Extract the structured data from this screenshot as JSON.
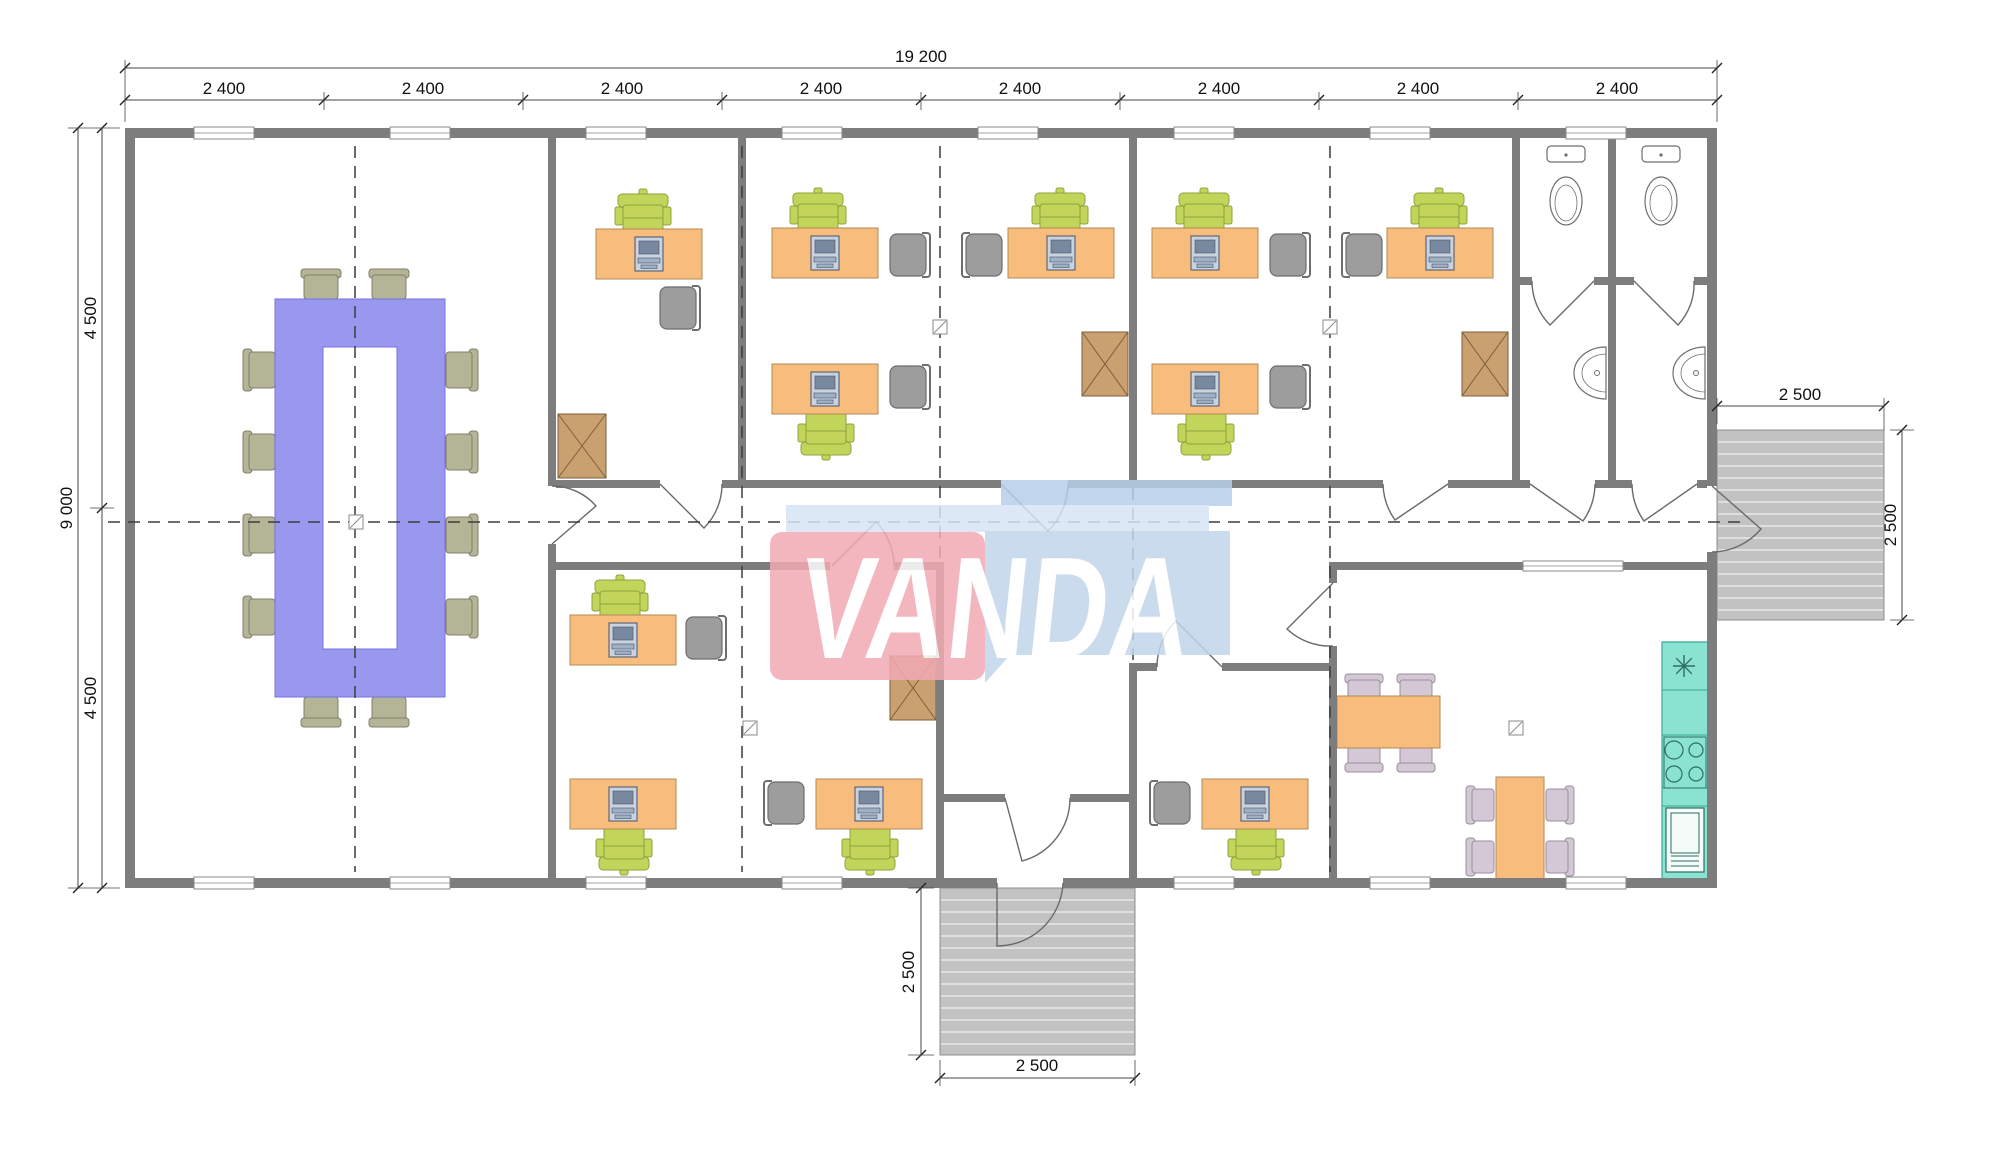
{
  "watermark": {
    "text": "VANDA",
    "red": "#f2aab3",
    "blue_body": "#c2d5ec",
    "blue_band": "#d6e4f4",
    "blue_strip": "#b7cfe9",
    "text_color": "#ffffff"
  },
  "dimensions": {
    "overall_width": "19 200",
    "bay": "2 400",
    "total_depth": "9 000",
    "half_depth": "4 500",
    "porch": "2 500"
  },
  "colors": {
    "wall": "#7d7d7d",
    "desk": "#f8bd7d",
    "desk_stroke": "#b08a55",
    "task_chair": "#c3d45b",
    "task_chair_stroke": "#8da33b",
    "guest_chair": "#9d9d9d",
    "guest_chair_stroke": "#6e6e6e",
    "conf_table": "#9a98ee",
    "conf_table_stroke": "#7472dd",
    "conf_chair": "#b4b497",
    "conf_chair_stroke": "#80806a",
    "dining_chair": "#d4c7d6",
    "dining_chair_stroke": "#9a8f9d",
    "cabinet": "#c9a06f",
    "cabinet_stroke": "#7e5f39",
    "counter": "#8ae2d1",
    "counter_stroke": "#3aa795",
    "porch": "#c2c2c2",
    "porch_stroke": "#8f8f8f",
    "fixture_stroke": "#6f6f6f",
    "axis": "#3d3d3d",
    "dim": "#444444",
    "door": "#6a6a6a",
    "monitor_body": "#c9d2df",
    "monitor_screen": "#77889f"
  },
  "plan": {
    "building": [
      125,
      128,
      1592,
      760
    ],
    "walls": [
      [
        125,
        128,
        1592,
        10
      ],
      [
        125,
        878,
        872,
        10
      ],
      [
        1063,
        878,
        654,
        10
      ],
      [
        125,
        138,
        10,
        740
      ],
      [
        1707,
        138,
        10,
        348
      ],
      [
        1707,
        552,
        10,
        326
      ],
      [
        548,
        138,
        8,
        348
      ],
      [
        548,
        544,
        8,
        334
      ],
      [
        738,
        138,
        8,
        342
      ],
      [
        1129,
        138,
        8,
        342
      ],
      [
        1512,
        138,
        8,
        342
      ],
      [
        1608,
        138,
        8,
        342
      ],
      [
        1516,
        277,
        16,
        8
      ],
      [
        1594,
        277,
        40,
        8
      ],
      [
        1694,
        277,
        13,
        8
      ],
      [
        556,
        480,
        104,
        8
      ],
      [
        722,
        480,
        279,
        8
      ],
      [
        1068,
        480,
        315,
        8
      ],
      [
        1448,
        480,
        82,
        8
      ],
      [
        1595,
        480,
        37,
        8
      ],
      [
        1697,
        480,
        10,
        8
      ],
      [
        556,
        562,
        274,
        8
      ],
      [
        894,
        562,
        50,
        8
      ],
      [
        1329,
        562,
        388,
        8
      ],
      [
        936,
        570,
        8,
        308
      ],
      [
        936,
        794,
        69,
        8
      ],
      [
        1070,
        794,
        67,
        8
      ],
      [
        1129,
        663,
        8,
        215
      ],
      [
        1133,
        663,
        24,
        8
      ],
      [
        1222,
        663,
        111,
        8
      ],
      [
        1329,
        570,
        8,
        13
      ],
      [
        1329,
        646,
        8,
        232
      ]
    ],
    "windows_top": [
      224,
      420,
      616,
      812,
      1008,
      1204,
      1400,
      1596
    ],
    "windows_bottom": [
      224,
      420,
      616,
      812,
      1204,
      1400,
      1596
    ],
    "window_interior": [
      1523,
      561,
      100,
      10
    ],
    "doors": [
      "M552,544 L596,506 A58,58 0 0 0 552,486",
      "M660,484 L704,528 A62,62 0 0 0 722,484",
      "M1001,484 L1048,531 A67,67 0 0 0 1068,484",
      "M832,566 L876,522 A62,62 0 0 1 894,566",
      "M1448,484 L1395,520 A65,65 0 0 1 1383,484",
      "M1530,484 L1583,521 A65,65 0 0 0 1595,484",
      "M1697,484 L1644,521 A65,65 0 0 1 1632,484",
      "M1594,281 L1550,325 A62,62 0 0 1 1532,281",
      "M1634,281 L1678,325 A60,60 0 0 0 1694,281",
      "M1005,798 L1022,861 A65,65 0 0 0 1070,798",
      "M997,883 L997,946 A66,66 0 0 0 1063,883",
      "M1712,486 L1761,529 A65,65 0 0 1 1712,552",
      "M1222,667 L1176,621 A65,65 0 0 0 1157,667",
      "M1333,583 L1287,629 A63,63 0 0 0 1333,646"
    ],
    "porches": [
      [
        1717,
        430,
        167,
        190
      ],
      [
        940,
        888,
        195,
        167
      ]
    ],
    "axes_vertical": [
      [
        355,
        146,
        872
      ],
      [
        742,
        146,
        872
      ],
      [
        940,
        146,
        560
      ],
      [
        1133,
        488,
        660
      ],
      [
        1330,
        146,
        872
      ]
    ],
    "axis_horizontal": [
      108,
      1745,
      522
    ],
    "grid_markers": [
      [
        356,
        522
      ],
      [
        940,
        327
      ],
      [
        1330,
        327
      ],
      [
        750,
        728
      ],
      [
        1516,
        728
      ]
    ],
    "furniture": {
      "desks": [
        [
          596,
          229
        ],
        [
          772,
          228
        ],
        [
          1008,
          228
        ],
        [
          772,
          364
        ],
        [
          1152,
          228
        ],
        [
          1387,
          228
        ],
        [
          1152,
          364
        ],
        [
          570,
          615
        ],
        [
          570,
          779
        ],
        [
          816,
          779
        ],
        [
          1202,
          779
        ]
      ],
      "task_chairs": [
        [
          615,
          194,
          0
        ],
        [
          790,
          193,
          0
        ],
        [
          1032,
          193,
          0
        ],
        [
          798,
          411,
          180
        ],
        [
          1176,
          193,
          0
        ],
        [
          1411,
          193,
          0
        ],
        [
          1178,
          411,
          180
        ],
        [
          592,
          580,
          0
        ],
        [
          596,
          826,
          180
        ],
        [
          842,
          826,
          180
        ],
        [
          1228,
          826,
          180
        ]
      ],
      "guest_chairs": [
        [
          656,
          284,
          "right"
        ],
        [
          886,
          231,
          "right"
        ],
        [
          962,
          231,
          "left"
        ],
        [
          886,
          363,
          "right"
        ],
        [
          1266,
          231,
          "right"
        ],
        [
          1342,
          231,
          "left"
        ],
        [
          1266,
          363,
          "right"
        ],
        [
          682,
          614,
          "right"
        ],
        [
          764,
          779,
          "left"
        ],
        [
          1150,
          779,
          "left"
        ]
      ],
      "cabinets": [
        [
          558,
          414,
          48,
          64
        ],
        [
          1082,
          332,
          46,
          64
        ],
        [
          1462,
          332,
          46,
          64
        ],
        [
          890,
          656,
          46,
          64
        ]
      ],
      "conference_table": {
        "outer": [
          275,
          299,
          170,
          398
        ],
        "hole": [
          323,
          347,
          74,
          302
        ]
      },
      "conference_chairs": [
        [
          301,
          269,
          "up"
        ],
        [
          369,
          269,
          "up"
        ],
        [
          301,
          697,
          "down"
        ],
        [
          369,
          697,
          "down"
        ],
        [
          243,
          349,
          "left"
        ],
        [
          243,
          431,
          "left"
        ],
        [
          243,
          514,
          "left"
        ],
        [
          243,
          596,
          "left"
        ],
        [
          446,
          349,
          "right"
        ],
        [
          446,
          431,
          "right"
        ],
        [
          446,
          514,
          "right"
        ],
        [
          446,
          596,
          "right"
        ]
      ],
      "dining_tables": [
        [
          1337,
          696,
          103,
          52
        ],
        [
          1496,
          777,
          48,
          106
        ]
      ],
      "dining_chairs": [
        [
          1345,
          674,
          "up"
        ],
        [
          1397,
          674,
          "up"
        ],
        [
          1345,
          744,
          "down"
        ],
        [
          1397,
          744,
          "down"
        ],
        [
          1466,
          786,
          "left"
        ],
        [
          1466,
          838,
          "left"
        ],
        [
          1546,
          786,
          "right"
        ],
        [
          1546,
          838,
          "right"
        ]
      ],
      "toilets": [
        1566,
        1661
      ],
      "sinks": [
        [
          1606,
          373
        ],
        [
          1705,
          373
        ]
      ],
      "kitchen": {
        "counter": [
          1662,
          642,
          46,
          240
        ],
        "dividers": [
          690,
          735,
          788,
          806
        ],
        "star": [
          1684,
          666
        ],
        "stove_rect": [
          1664,
          737,
          42,
          51
        ],
        "burners": [
          [
            1674,
            750,
            9
          ],
          [
            1674,
            774,
            8
          ],
          [
            1696,
            750,
            7
          ],
          [
            1696,
            774,
            7
          ]
        ],
        "fridge": [
          1666,
          808,
          38,
          64
        ]
      }
    },
    "dim_lines": {
      "h": [
        [
          125,
          1717,
          68
        ],
        [
          125,
          1717,
          100
        ],
        [
          1717,
          1884,
          406
        ],
        [
          940,
          1135,
          1078
        ]
      ],
      "v": [
        [
          78,
          128,
          888
        ],
        [
          102,
          128,
          888
        ],
        [
          1902,
          430,
          620
        ],
        [
          921,
          888,
          1055
        ]
      ],
      "h_ticks": [
        [
          125,
          68
        ],
        [
          1717,
          68
        ],
        [
          125,
          100
        ],
        [
          324,
          100
        ],
        [
          523,
          100
        ],
        [
          722,
          100
        ],
        [
          921,
          100
        ],
        [
          1120,
          100
        ],
        [
          1319,
          100
        ],
        [
          1518,
          100
        ],
        [
          1717,
          100
        ],
        [
          1717,
          406
        ],
        [
          1884,
          406
        ],
        [
          940,
          1078
        ],
        [
          1135,
          1078
        ]
      ],
      "v_ticks": [
        [
          78,
          128
        ],
        [
          78,
          888
        ],
        [
          102,
          128
        ],
        [
          102,
          508
        ],
        [
          102,
          888
        ],
        [
          1902,
          430
        ],
        [
          1902,
          620
        ],
        [
          921,
          888
        ],
        [
          921,
          1055
        ]
      ],
      "ext": [
        [
          125,
          60,
          125,
          122
        ],
        [
          1717,
          60,
          1717,
          122
        ],
        [
          324,
          92,
          324,
          110
        ],
        [
          523,
          92,
          523,
          110
        ],
        [
          722,
          92,
          722,
          110
        ],
        [
          921,
          92,
          921,
          110
        ],
        [
          1120,
          92,
          1120,
          110
        ],
        [
          1319,
          92,
          1319,
          110
        ],
        [
          1518,
          92,
          1518,
          110
        ],
        [
          68,
          128,
          120,
          128
        ],
        [
          68,
          888,
          120,
          888
        ],
        [
          90,
          508,
          114,
          508
        ],
        [
          1717,
          398,
          1717,
          424
        ],
        [
          1884,
          398,
          1884,
          430
        ],
        [
          1890,
          430,
          1914,
          430
        ],
        [
          1890,
          620,
          1914,
          620
        ],
        [
          908,
          888,
          934,
          888
        ],
        [
          908,
          1055,
          934,
          1055
        ],
        [
          940,
          1060,
          940,
          1086
        ],
        [
          1135,
          1060,
          1135,
          1086
        ]
      ]
    }
  }
}
